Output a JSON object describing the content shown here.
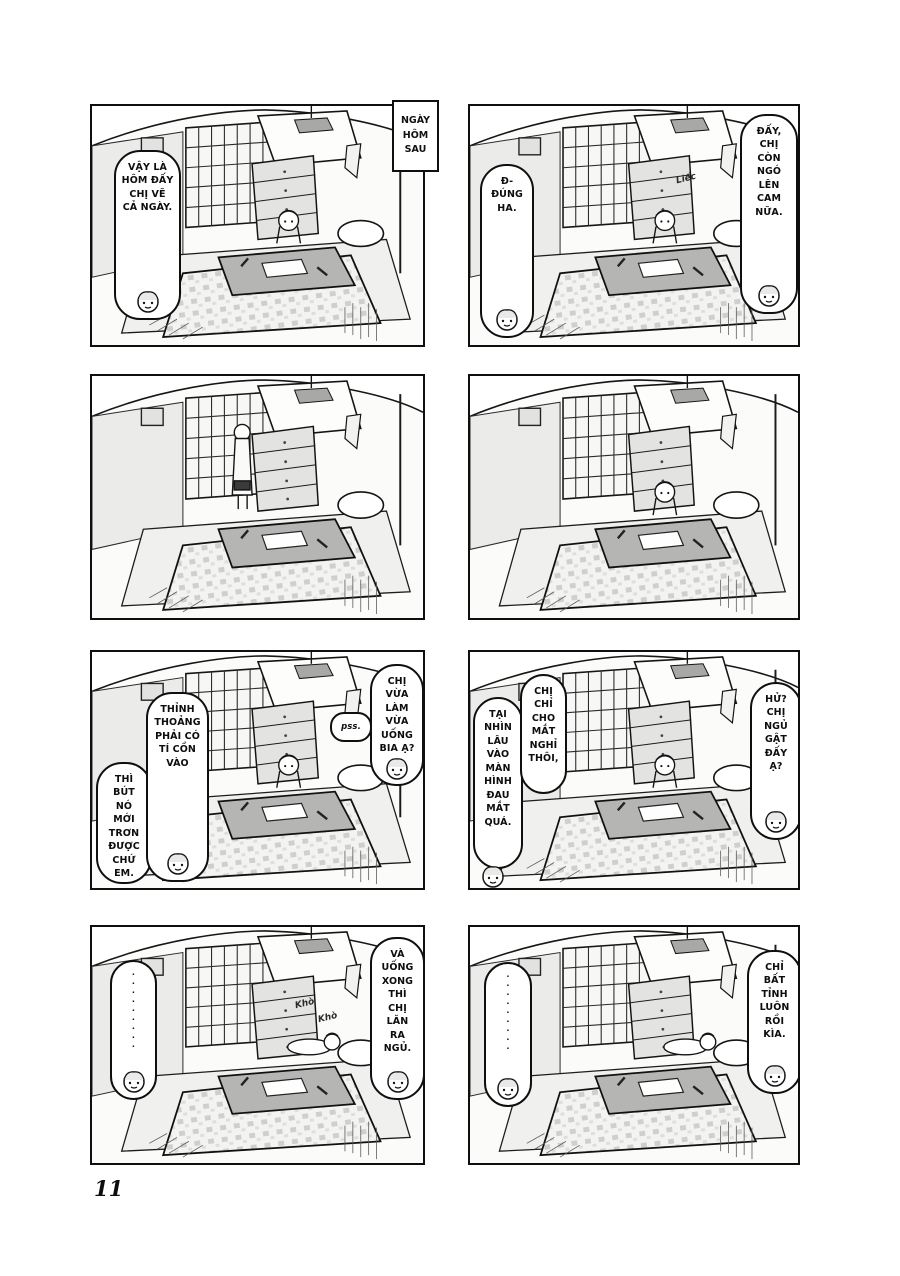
{
  "page": {
    "number": "11",
    "caption": "NGÀY\nHÔM\nSAU"
  },
  "panels": [
    {
      "name": "panel-1",
      "bubbles": [
        {
          "text": "VẬY LÀ\nHÔM ĐẤY\nCHỊ VẼ\nCẢ NGÀY."
        }
      ]
    },
    {
      "name": "panel-2",
      "bubbles": [
        {
          "text": "Đ-\nĐÚNG\nHA."
        },
        {
          "text": "ĐẤY,\nCHỊ\nCÒN\nNGÓ\nLÊN\nCAM\nNỮA."
        }
      ],
      "sfx": [
        "Liếc"
      ]
    },
    {
      "name": "panel-3",
      "bubbles": []
    },
    {
      "name": "panel-4",
      "bubbles": []
    },
    {
      "name": "panel-5",
      "bubbles": [
        {
          "text": "THÌ\nBÚT\nNÓ\nMỚI\nTRƠN\nĐƯỢC\nCHỨ\nEM."
        },
        {
          "text": "THỈNH\nTHOẢNG\nPHẢI CÓ\nTÍ CỒN\nVÀO"
        },
        {
          "text": "pss."
        },
        {
          "text": "CHỊ VỪA\nLÀM VỪA\nUỐNG\nBIA Ạ?"
        }
      ]
    },
    {
      "name": "panel-6",
      "bubbles": [
        {
          "text": "TẠI\nNHÌN\nLÂU\nVÀO\nMÀN\nHÌNH\nĐAU\nMẮT\nQUÁ."
        },
        {
          "text": "CHỊ\nCHỈ\nCHO\nMẮT\nNGHỈ\nTHÔI,"
        },
        {
          "text": "HỬ?\nCHỊ\nNGỦ\nGẬT\nĐẤY\nẠ?"
        }
      ]
    },
    {
      "name": "panel-7",
      "bubbles": [
        {
          "text": "·\n·\n·\n·\n·\n·\n·\n·\n·"
        },
        {
          "text": "VÀ\nUỐNG\nXONG\nTHÌ\nCHỊ\nLĂN\nRA\nNGỦ."
        }
      ],
      "sfx": [
        "Khò",
        "Khò"
      ]
    },
    {
      "name": "panel-8",
      "bubbles": [
        {
          "text": "·\n·\n·\n·\n·\n·\n·\n·\n·"
        },
        {
          "text": "CHỈ\nBẤT\nTỈNH\nLUÔN\nRỒI\nKÌA."
        }
      ]
    }
  ],
  "colors": {
    "ink": "#0f0f0f",
    "paper": "#ffffff",
    "tone_gray": "#b5b5b3"
  }
}
